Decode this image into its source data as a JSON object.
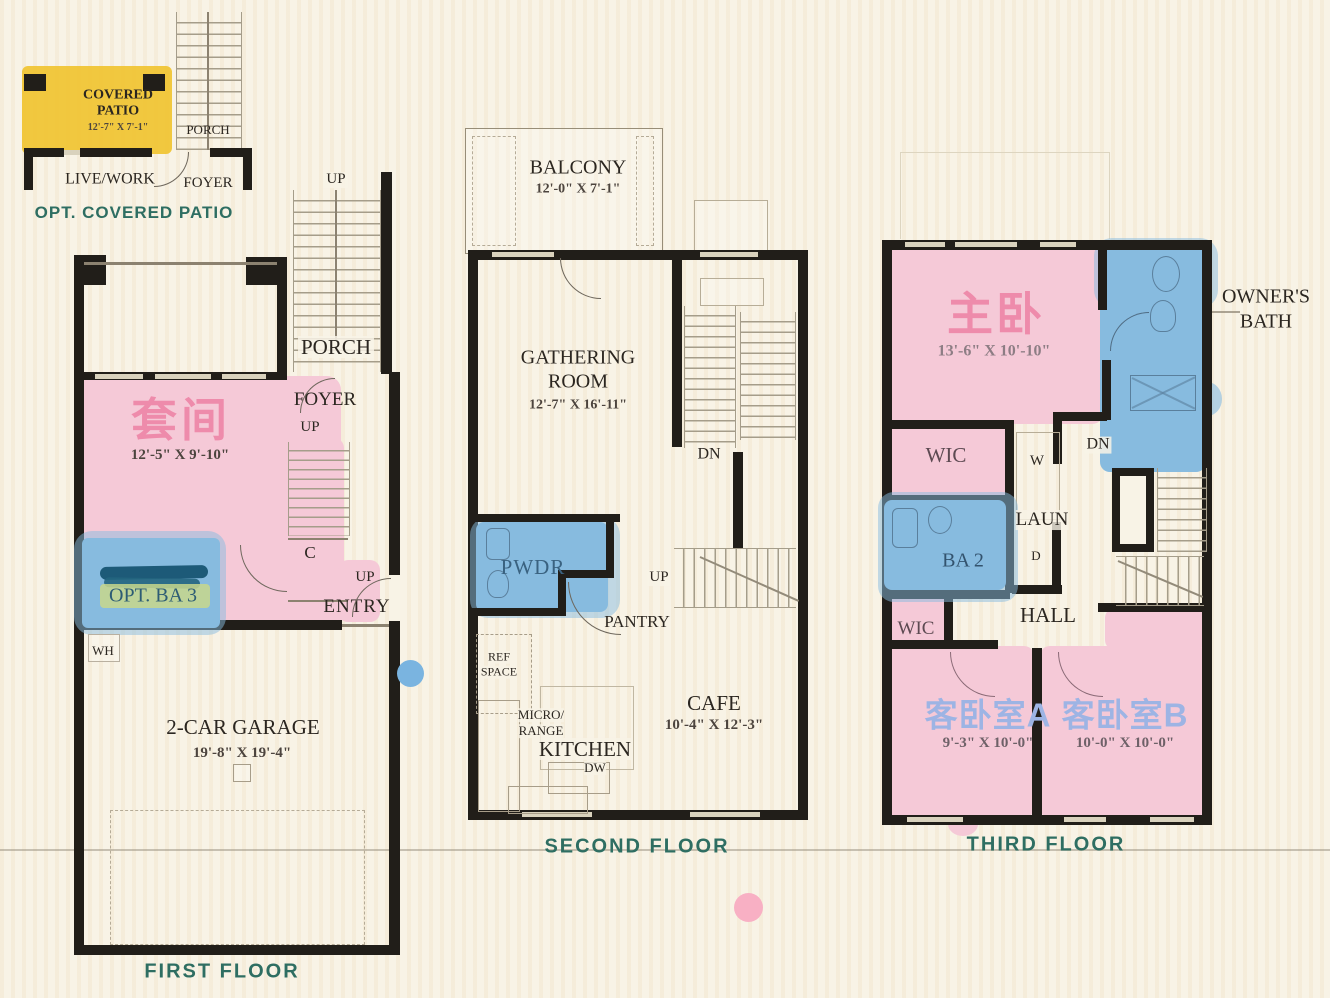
{
  "palette": {
    "highlight_pink": "#f5c9d7",
    "highlight_blue": "#87bbdf",
    "highlight_yellow": "#f0c431",
    "annotation_pink_text": "#ee8bab",
    "annotation_periwinkle_text": "#9db4e4",
    "caption_teal": "#2e6e62",
    "wall_black": "#211e19"
  },
  "floor1": {
    "caption": "FIRST FLOOR",
    "patio_inset": {
      "caption": "OPT. COVERED PATIO",
      "covered_patio_line1": "COVERED",
      "covered_patio_line2": "PATIO",
      "covered_patio_dims": "12'-7\" X 7'-1\"",
      "porch": "PORCH",
      "live_work": "LIVE/WORK",
      "foyer": "FOYER"
    },
    "rooms": {
      "up_porch": "UP",
      "porch": "PORCH",
      "foyer": "FOYER",
      "up_foyer": "UP",
      "suite_annotation": "套间",
      "suite_dims": "12'-5\" X 9'-10\"",
      "closet": "C",
      "up_entry": "UP",
      "entry": "ENTRY",
      "opt_ba3": "OPT. BA 3",
      "water_heater": "WH",
      "garage": "2-CAR GARAGE",
      "garage_dims": "19'-8\" X 19'-4\""
    }
  },
  "floor2": {
    "caption": "SECOND FLOOR",
    "rooms": {
      "balcony": "BALCONY",
      "balcony_dims": "12'-0\" X 7'-1\"",
      "gathering_line1": "GATHERING",
      "gathering_line2": "ROOM",
      "gathering_dims": "12'-7\" X 16'-11\"",
      "dn": "DN",
      "pwdr": "PWDR",
      "up": "UP",
      "pantry": "PANTRY",
      "ref_line1": "REF",
      "ref_line2": "SPACE",
      "micro_line1": "MICRO/",
      "micro_line2": "RANGE",
      "kitchen": "KITCHEN",
      "dw": "DW",
      "cafe": "CAFE",
      "cafe_dims": "10'-4\" X 12'-3\""
    }
  },
  "floor3": {
    "caption": "THIRD FLOOR",
    "rooms": {
      "master_annotation": "主卧",
      "master_dims": "13'-6\" X 10'-10\"",
      "owners_bath_line1": "OWNER'S",
      "owners_bath_line2": "BATH",
      "wic_upper": "WIC",
      "washer": "W",
      "dn": "DN",
      "laundry": "LAUN",
      "dryer": "D",
      "ba2": "BA 2",
      "wic_lower": "WIC",
      "hall": "HALL",
      "bedroom_a_annotation": "客卧室A",
      "bedroom_a_dims": "9'-3\" X 10'-0\"",
      "bedroom_b_annotation": "客卧室B",
      "bedroom_b_dims": "10'-0\" X 10'-0\""
    }
  }
}
